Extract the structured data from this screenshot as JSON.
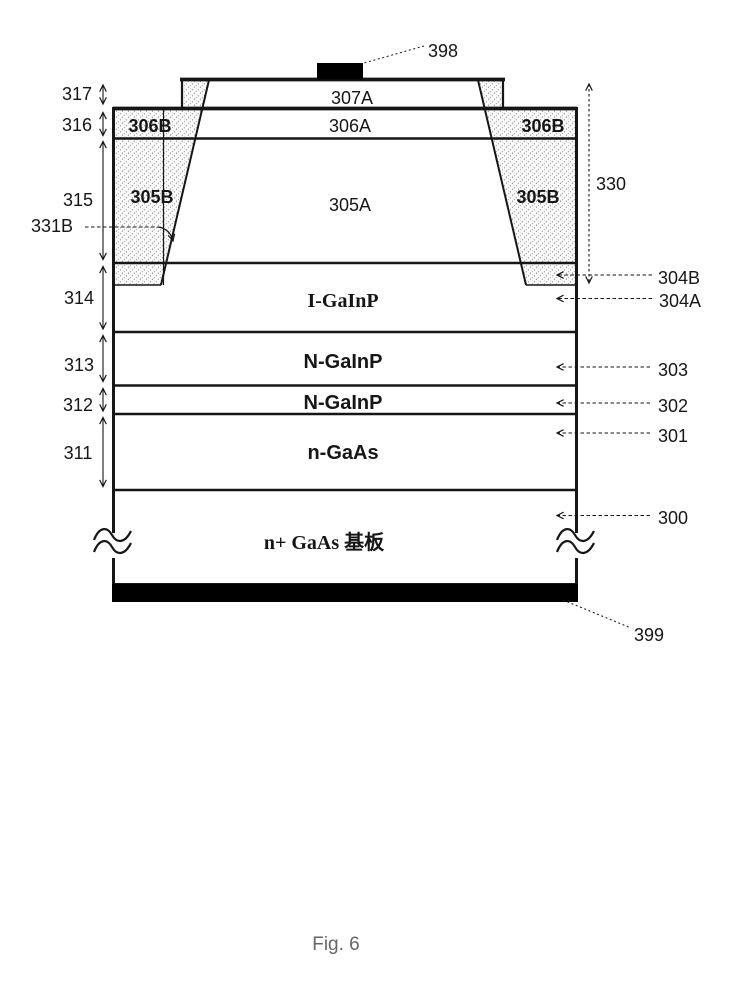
{
  "figure": {
    "caption": "Fig. 6",
    "colors": {
      "line": "#161616",
      "hatch_stroke": "#7a7a7a",
      "contact_fill": "#000000",
      "background": "#ffffff",
      "caption_text": "#666666"
    },
    "layers": {
      "l307A": "307A",
      "l306A": "306A",
      "l306B_left": "306B",
      "l306B_right": "306B",
      "l305A": "305A",
      "l305B_left": "305B",
      "l305B_right": "305B",
      "i_gainp": "I-GaInP",
      "n_gainp_upper": "N-GaInP",
      "n_gainp_lower": "N-GaInP",
      "n_gaas": "n-GaAs",
      "substrate": "n+ GaAs 基板"
    },
    "refs": {
      "top_contact": "398",
      "bottom_contact": "399",
      "r331B": "331B",
      "r330": "330",
      "r304B": "304B",
      "r304A": "304A",
      "r303": "303",
      "r302": "302",
      "r301": "301",
      "r300": "300"
    },
    "dims": {
      "d317": "317",
      "d316": "316",
      "d315": "315",
      "d314": "314",
      "d313": "313",
      "d312": "312",
      "d311": "311"
    }
  }
}
